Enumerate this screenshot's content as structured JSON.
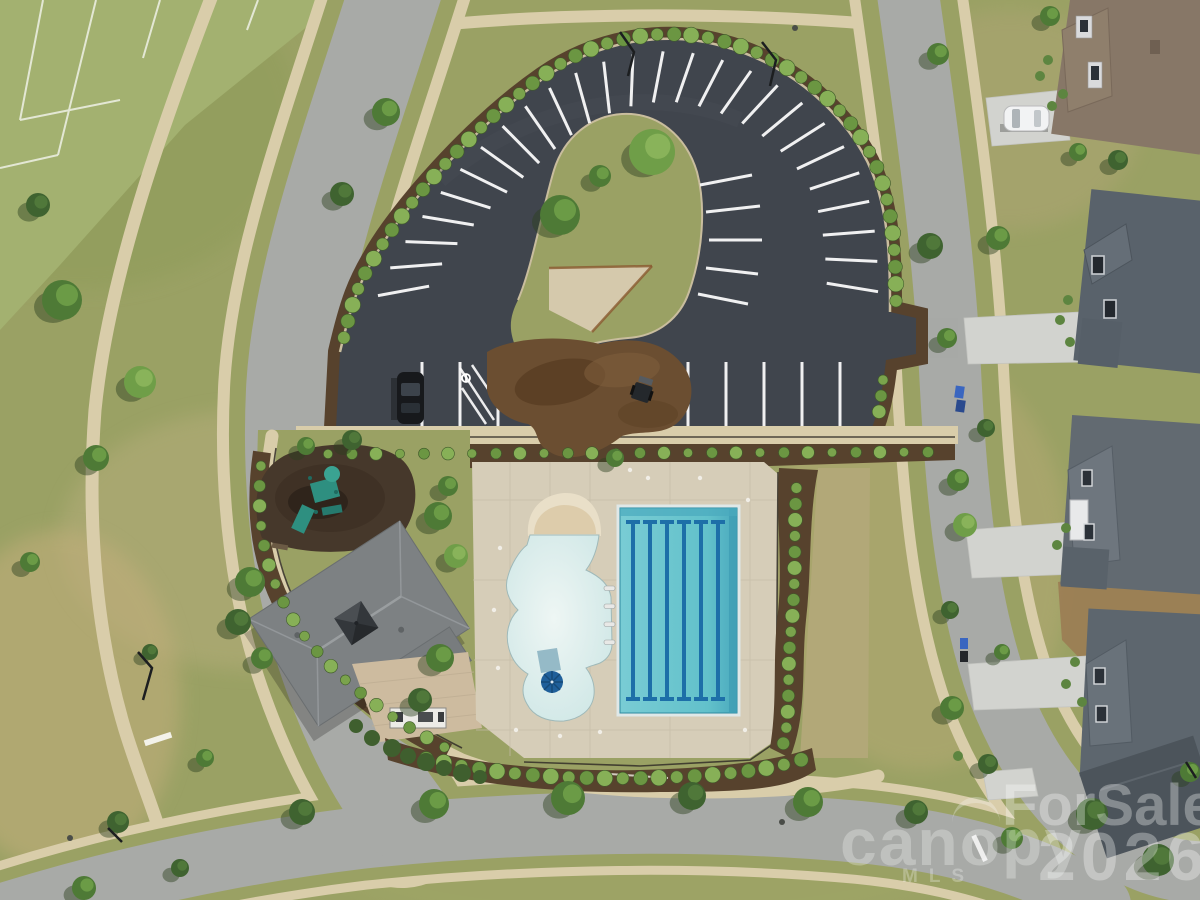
{
  "scene": {
    "description": "Aerial drone photo of a community amenity center: horseshoe parking lot, clubhouse, leisure pool with beach entry, seven-lane lap pool, playground, landscaped streets and houses"
  },
  "watermarks": {
    "mls_brand": "canopy",
    "mls_sub": "MLS",
    "overlay_line1": "ForSale",
    "overlay_line2": "2026"
  },
  "palette": {
    "grass": "#9aa164",
    "grassLight": "#a8b172",
    "grassDark": "#8a985c",
    "dry": "#bba87a",
    "field": "#a3b170",
    "road": "#a8aaa7",
    "sidewalk": "#d9cdaa",
    "driveway": "#d2d3cf",
    "asphalt": "#40454d",
    "asphaltEdge": "#c9bd9e",
    "mulch": "#57422d",
    "mulchDark": "#46331f",
    "pile": "#6b4e31",
    "deck": "#d6cdb8",
    "deckLine": "#c6bda7",
    "sand": "#e9dfc8",
    "poolLight": "#eef6f4",
    "pool": "#cfe7e6",
    "lap": "#6ac6cf",
    "lapDark": "#3e9eb4",
    "lane": "#1d6fa8",
    "umbrella": "#1f5f9a",
    "roofA": "#877767",
    "roofB": "#59626b",
    "roofC": "#626a71",
    "roofD": "#5d666e",
    "roofE": "#4c545b",
    "clubRoof": "#7d8183",
    "tree": "#4e7a36",
    "treeHi": "#6f9e48",
    "treeDark": "#3f6330",
    "treeShadow": "#2c401f",
    "shrub": "#7aa34c",
    "playSurface": "#46382b",
    "playset": "#2e8f80",
    "stripe": "#ffffff",
    "fence": "#332e28",
    "dirt": "#9b7a52",
    "lawnTan": "#b2a878"
  },
  "parking": {
    "arc_stripe_count": 26,
    "row_stripe_count": 12,
    "inner_stripe_count": 5,
    "accessible_spaces": 1
  },
  "pool": {
    "lap_lane_line_count": 6,
    "lap_lane_count": 7,
    "ladder_count": 4,
    "umbrella_count": 1
  },
  "vehicles": {
    "white_suv_count": 1,
    "dark_car_count": 1,
    "skid_steer_count": 1
  }
}
